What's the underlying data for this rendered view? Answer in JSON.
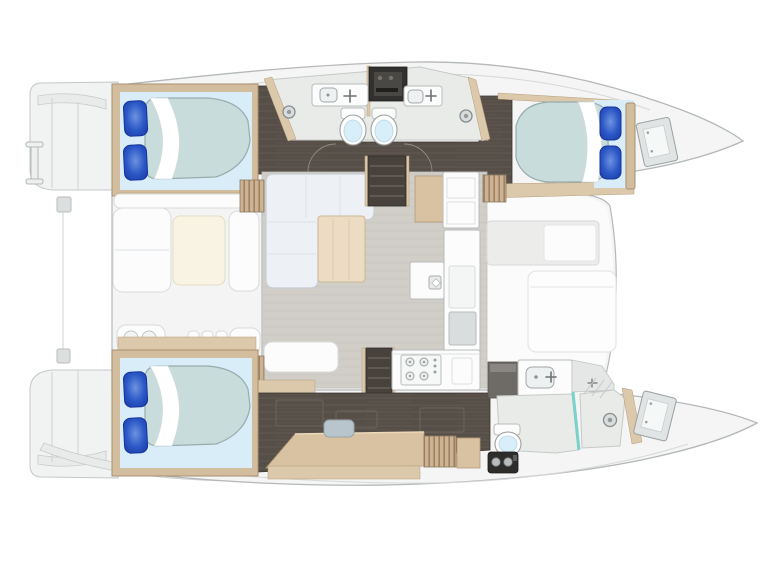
{
  "description": "Catamaran sailing yacht interior floor plan, top-down view, bow pointing right",
  "colors": {
    "hull_fill": "#f4f5f4",
    "hull_stroke": "#b4b8ba",
    "hull_inner_line": "#d6d9d9",
    "deck_fill": "#f3f4f3",
    "platform_fill": "#f1f2f2",
    "platform_stroke": "#c4c7c9",
    "floor_dark": "#564f48",
    "floor_grain": "#6e655b",
    "wood_frame": "#d3bd9f",
    "wood_frame_edge": "#a8906d",
    "wood_shelf": "#dcc9ab",
    "wood_desk": "#d8c2a2",
    "bed_sheet": "#d9edf8",
    "mattress_fill": "#c7dcdb",
    "mattress_stroke": "#97adad",
    "pillow_fill": "#2b57c6",
    "pillow_edge": "#16339b",
    "pillow_light": "#6e93e0",
    "bath_floor": "#e9ebe8",
    "fixture_white": "#fbfcfb",
    "fixture_stroke": "#b8bcbc",
    "sink_fill": "#edf1f1",
    "toilet_seat": "#d8eef8",
    "salon_floor": "#d1cec8",
    "sofa_fill": "#edf0f4",
    "sofa_stroke": "#c7cdd4",
    "sofa_seam": "#dde2e7",
    "table_wood": "#ecdcc3",
    "table_wood_stroke": "#cdb795",
    "cream_fill": "#f8f3e2",
    "cream_stroke": "#e3dcc5",
    "appliance_dark": "#32312f",
    "appliance_panel": "#4a4845",
    "glass_teal": "#6fcfc7",
    "stool_fill": "#b9c5cd",
    "stool_stroke": "#96a4ac",
    "recess_fill": "#ececea",
    "recess_stroke": "#d6d9d8",
    "counter_gray": "#e4e7e5",
    "black_unit": "#2e2d2c",
    "metal_gray": "#b9bdbe",
    "locker_fill": "#e1e4e4",
    "locker_stroke": "#9aa0a2",
    "slat_wood": "#cdb392",
    "slat_line": "#9c8364",
    "arc_line": "#908a82"
  },
  "layout": {
    "orientation": "bow right, sterns with swim platforms left",
    "port_hull": {
      "aft_cabin": "double berth, two blue pillows, white duvet fold",
      "head": "two vanities with sinks, dark appliance, two toilets back to back, two shower heads",
      "forward_cabin": "double berth, two blue pillows",
      "bow": "anchor locker"
    },
    "starboard_hull": {
      "aft_cabin": "double berth, two blue pillows, white duvet fold",
      "corridor": "dark wood sole, desk with stool, slatted shelf, floor hatches",
      "head": "vanity with sink, glass shower with shower head, toilet, black appliance",
      "bow": "locker"
    },
    "bridge_deck": {
      "cockpit": "bench seating, cream table, seat lockers, small fittings",
      "salon": "L-shaped sofa, wooden table, side seat, companionway stairs to each hull",
      "galley": "cabinet column, island with sink, counter with four-burner stove, fridge panel",
      "foredeck": "storage recess and lounge pad"
    }
  },
  "totals": {
    "cabins": 3,
    "toilets": 3,
    "vanity_sinks": 3,
    "shower_heads": 3,
    "pillows": 6
  }
}
